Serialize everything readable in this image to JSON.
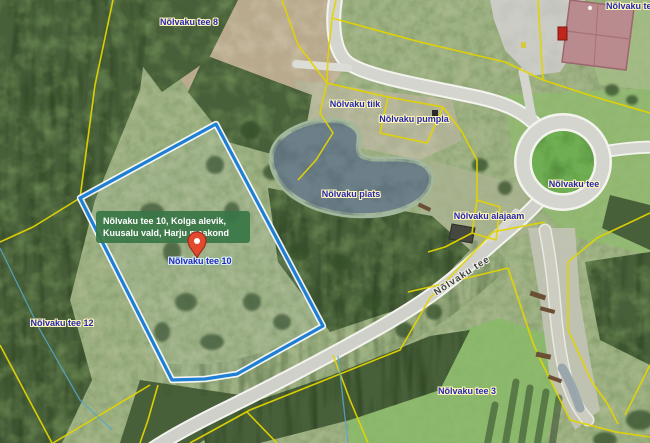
{
  "map": {
    "labels": {
      "tee8": "Nõlvaku tee 8",
      "tee5_clipped": "Nõlvaku te",
      "tiik": "Nõlvaku tiik",
      "pumpla": "Nõlvaku pumpla",
      "plats": "Nõlvaku plats",
      "tee_roundabout": "Nõlvaku tee",
      "alajaam": "Nõlvaku alajaam",
      "tee10_marker": "Nõlvaku tee 10",
      "tee12": "Nõlvaku tee 12",
      "tee3": "Nõlvaku tee 3",
      "tee_road": "Nõlvaku tee"
    },
    "tooltip": {
      "text": "Nõlvaku tee 10, Kolga alevik, Kuusalu vald, Harju maakond"
    },
    "marker": {
      "icon": "location-pin-icon",
      "color": "#e3492f"
    },
    "colors": {
      "parcel_highlight": "#1f7fd4",
      "cadastral_line": "#e3d400",
      "tooltip_bg": "#3a7a46",
      "label_text": "#2626b5",
      "label_halo": "#fdf6b8",
      "water": "#6d8089",
      "road": "#d6d7d0"
    }
  }
}
